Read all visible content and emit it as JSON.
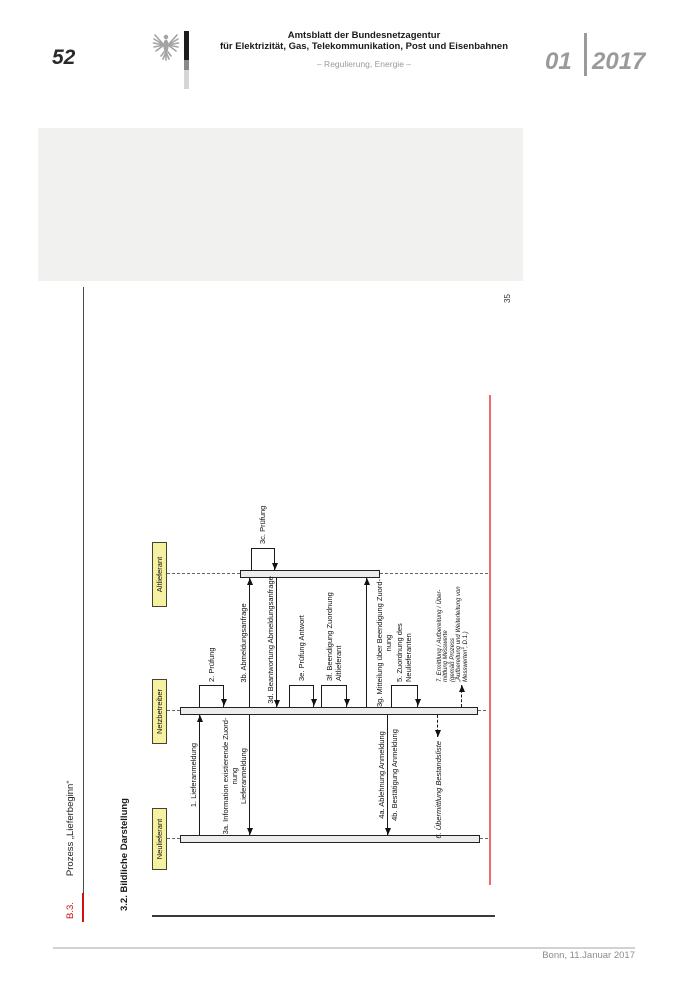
{
  "header": {
    "page_number": "52",
    "title_line1": "Amtsblatt der Bundesnetzagentur",
    "title_line2": "für Elektrizität, Gas, Telekommunikation, Post und Eisenbahnen",
    "subtitle": "– Regulierung, Energie –",
    "issue_month": "01",
    "issue_year": "2017"
  },
  "margin": {
    "chapter_ref": "B.3.",
    "chapter_title": "Prozess „Lieferbeginn“",
    "inner_page_number": "35",
    "section_heading": "3.2. Bildliche Darstellung"
  },
  "footer": {
    "dateline": "Bonn, 11.Januar 2017"
  },
  "colors": {
    "accent-red": "#ef6b6b",
    "actor-fill": "#f5f1a0",
    "bar-fill": "#ececec",
    "heading-red": "#cc1111",
    "placeholder-gray": "#f1f1ef"
  },
  "diagram": {
    "type": "sequence",
    "rules": [
      {
        "name": "figure-border-line",
        "x": 0,
        "y": 2,
        "w": 1.8,
        "h": 343,
        "color": "#3a3a3a"
      },
      {
        "name": "red-margin-line",
        "x": 32,
        "y": 339,
        "w": 490,
        "h": 2.4,
        "color": "#ef6b6b"
      }
    ],
    "actors": [
      {
        "id": "neulieferant",
        "name": "Neulieferant",
        "box": {
          "x": 47,
          "w": 62
        },
        "cx": 78,
        "bar": {
          "y1": 30,
          "y2": 330,
          "w": 7.5
        },
        "life": [
          [
            17,
            30
          ],
          [
            330,
            338
          ]
        ]
      },
      {
        "id": "netzbetreiber",
        "name": "Netzbetreiber",
        "box": {
          "x": 173,
          "w": 65
        },
        "cx": 206,
        "bar": {
          "y1": 30,
          "y2": 328,
          "w": 8
        },
        "life": [
          [
            17,
            30
          ],
          [
            328,
            336
          ]
        ]
      },
      {
        "id": "altlieferant",
        "name": "Altlieferant",
        "box": {
          "x": 310,
          "w": 65
        },
        "cx": 343,
        "bar": {
          "y1": 90,
          "y2": 230,
          "w": 7.5
        },
        "life": [
          [
            17,
            90
          ],
          [
            230,
            338
          ]
        ]
      }
    ],
    "arrows": [
      {
        "name": "msg-1-lieferanmeldung-arrow",
        "x1": 82,
        "x2": 202,
        "y": 50,
        "head": "r"
      },
      {
        "name": "msg-3a-information-arrow",
        "x1": 82,
        "x2": 202,
        "y": 100,
        "head": "l"
      },
      {
        "name": "msg-3b-abmeldungsanfrage-arrow",
        "x1": 210,
        "x2": 339,
        "y": 100,
        "head": "r"
      },
      {
        "name": "msg-3d-beantwortung-arrow",
        "x1": 210,
        "x2": 339,
        "y": 127,
        "head": "l"
      },
      {
        "name": "msg-3g-mitteilung-arrow",
        "x1": 210,
        "x2": 339,
        "y": 217,
        "head": "r"
      },
      {
        "name": "msg-4-anmeldung-arrow",
        "x1": 82,
        "x2": 202,
        "y": 238,
        "head": "l"
      },
      {
        "name": "msg-6-bestandsliste-arrow",
        "x1": 180,
        "x2": 202,
        "y": 288,
        "head": "l",
        "dash": true
      },
      {
        "name": "msg-7-messwerte-arrow",
        "x1": 210,
        "x2": 232,
        "y": 312,
        "head": "r",
        "dash": true
      }
    ],
    "loops": [
      {
        "name": "msg-2-pruefung-loop",
        "bx": 210,
        "ax": 232,
        "y1": 50,
        "y2": 74
      },
      {
        "name": "msg-3c-pruefung-loop",
        "bx": 346.5,
        "ax": 369,
        "y1": 102,
        "y2": 125
      },
      {
        "name": "msg-3e-pruefung-antwort-loop",
        "bx": 210,
        "ax": 232,
        "y1": 140,
        "y2": 164
      },
      {
        "name": "msg-3f-beendigung-loop",
        "bx": 210,
        "ax": 232,
        "y1": 172,
        "y2": 197
      },
      {
        "name": "msg-5-zuordnung-loop",
        "bx": 210,
        "ax": 232,
        "y1": 242,
        "y2": 268
      }
    ],
    "labels": [
      {
        "name": "msg-1-label",
        "lines": [
          "1. Lieferanmeldung"
        ],
        "x": 142,
        "y": 39,
        "align": "center"
      },
      {
        "name": "msg-2-label",
        "lines": [
          "2. Prüfung"
        ],
        "x": 235,
        "y": 57,
        "align": "left"
      },
      {
        "name": "msg-3a-label",
        "lines": [
          "3a. Information existierende Zuord-",
          "nung",
          "Lieferanmeldung"
        ],
        "x": 141,
        "y": 71,
        "align": "center"
      },
      {
        "name": "msg-3b-label",
        "lines": [
          "3b. Abmeldungsanfrage"
        ],
        "x": 274,
        "y": 89,
        "align": "center"
      },
      {
        "name": "msg-3c-label",
        "lines": [
          "3c. Prüfung"
        ],
        "x": 373,
        "y": 108,
        "align": "left"
      },
      {
        "name": "msg-3d-label",
        "lines": [
          "3d. Beantwortung Abmeldungsanfrage"
        ],
        "x": 277,
        "y": 116,
        "align": "center"
      },
      {
        "name": "msg-3e-label",
        "lines": [
          "3e. Prüfung Antwort"
        ],
        "x": 236,
        "y": 147,
        "align": "left"
      },
      {
        "name": "msg-3f-label",
        "lines": [
          "3f. Beendigung Zuordnung",
          "Altlieferant"
        ],
        "x": 236,
        "y": 176,
        "align": "left",
        "lh": 8.5
      },
      {
        "name": "msg-3g-label",
        "lines": [
          "3g. Mitteilung über Beendigung Zuord-",
          "nung"
        ],
        "x": 274,
        "y": 226,
        "align": "center",
        "lh": 8.5
      },
      {
        "name": "msg-4a-label",
        "lines": [
          "4a. Ablehnung Anmeldung"
        ],
        "x": 142,
        "y": 227,
        "align": "center"
      },
      {
        "name": "msg-4b-label",
        "lines": [
          "4b. Bestätigung Anmeldung"
        ],
        "x": 142,
        "y": 240,
        "align": "center"
      },
      {
        "name": "msg-5-label",
        "lines": [
          "5. Zuordnung des",
          "Neulieferanten"
        ],
        "x": 235,
        "y": 246,
        "align": "left",
        "lh": 8.5
      },
      {
        "name": "msg-6-label",
        "lines": [
          "6. Übermittlung Bestandsliste"
        ],
        "x": 176,
        "y": 283.5,
        "align": "right",
        "it": true
      },
      {
        "name": "msg-7-label",
        "lines": [
          "7. Ermittlung / Aufbereitung / Über-",
          "mittlung Messwerte",
          "(gemäß Prozess",
          "„Aufbereitung und Weiterleitung von",
          "Messwerten“, D.1.)"
        ],
        "x": 235,
        "y": 287,
        "align": "left",
        "it": true,
        "fs": 6,
        "lh": 6.4
      }
    ]
  }
}
